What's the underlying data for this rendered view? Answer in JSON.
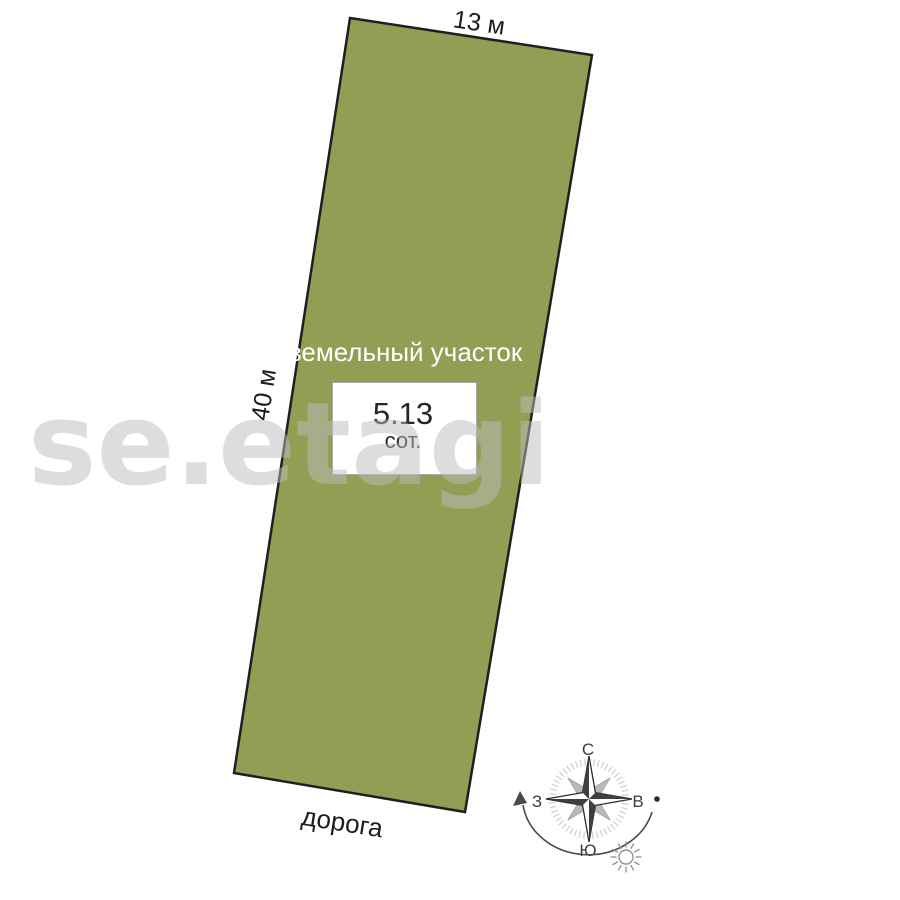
{
  "plot": {
    "title": "земельный участок",
    "area_value": "5.13",
    "area_unit": "сот.",
    "width_label": "13 м",
    "length_label": "40 м",
    "road_label": "дорога",
    "fill_color": "#939e55",
    "border_color": "#1f1f1f"
  },
  "compass": {
    "north": "С",
    "south": "Ю",
    "west": "З",
    "east": "В"
  },
  "watermark": {
    "text": "se.etagi"
  }
}
